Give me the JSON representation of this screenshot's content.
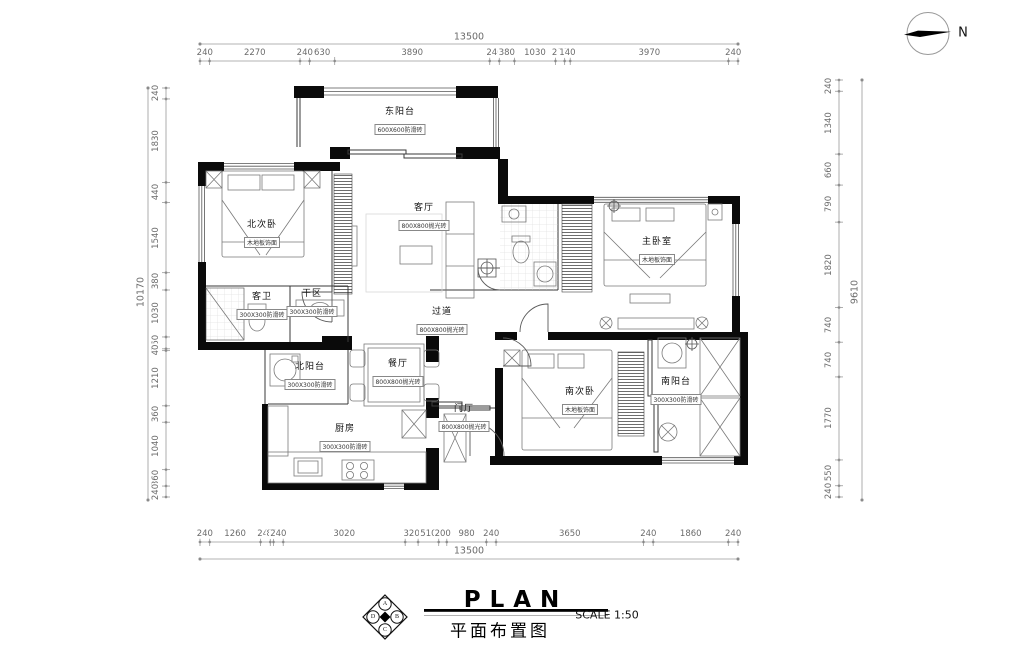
{
  "meta": {
    "title_en": "PLAN",
    "title_cn": "平面布置图",
    "scale": "SCALE 1:50",
    "north_label": "N",
    "logo_letters": [
      "A",
      "B",
      "C",
      "D"
    ]
  },
  "dimensions": {
    "top": {
      "overall": "13500",
      "segments": [
        "240",
        "2270",
        "240",
        "630",
        "3890",
        "240",
        "380",
        "1030",
        "230",
        "140",
        "3970",
        "240"
      ]
    },
    "bottom": {
      "overall": "13500",
      "segments": [
        "240",
        "1260",
        "240",
        "80",
        "240",
        "3020",
        "320",
        "510",
        "200",
        "980",
        "240",
        "3650",
        "240",
        "1860",
        "240"
      ]
    },
    "left": {
      "overall": "10170",
      "segments": [
        "240",
        "1830",
        "440",
        "1540",
        "380",
        "1030",
        "260",
        "40",
        "1210",
        "360",
        "1040",
        "360",
        "240"
      ]
    },
    "right": {
      "overall": "9610",
      "segments": [
        "240",
        "1340",
        "660",
        "790",
        "1820",
        "740",
        "740",
        "1770",
        "550",
        "240"
      ]
    }
  },
  "rooms": [
    {
      "name": "东阳台",
      "finish": "600X600防滑砖"
    },
    {
      "name": "北次卧",
      "finish": "木地板饰面"
    },
    {
      "name": "客厅",
      "finish": "800X800抛光砖"
    },
    {
      "name": "主卧室",
      "finish": "木地板饰面"
    },
    {
      "name": "过道",
      "finish": "800X800抛光砖"
    },
    {
      "name": "客卫",
      "finish": "300X300防滑砖"
    },
    {
      "name": "干区",
      "finish": "300X300防滑砖"
    },
    {
      "name": "北阳台",
      "finish": "300X300防滑砖"
    },
    {
      "name": "餐厅",
      "finish": "800X800抛光砖"
    },
    {
      "name": "厨房",
      "finish": "300X300防滑砖"
    },
    {
      "name": "门厅",
      "finish": "800X800抛光砖"
    },
    {
      "name": "南次卧",
      "finish": "木地板饰面"
    },
    {
      "name": "南阳台",
      "finish": "300X300防滑砖"
    }
  ]
}
